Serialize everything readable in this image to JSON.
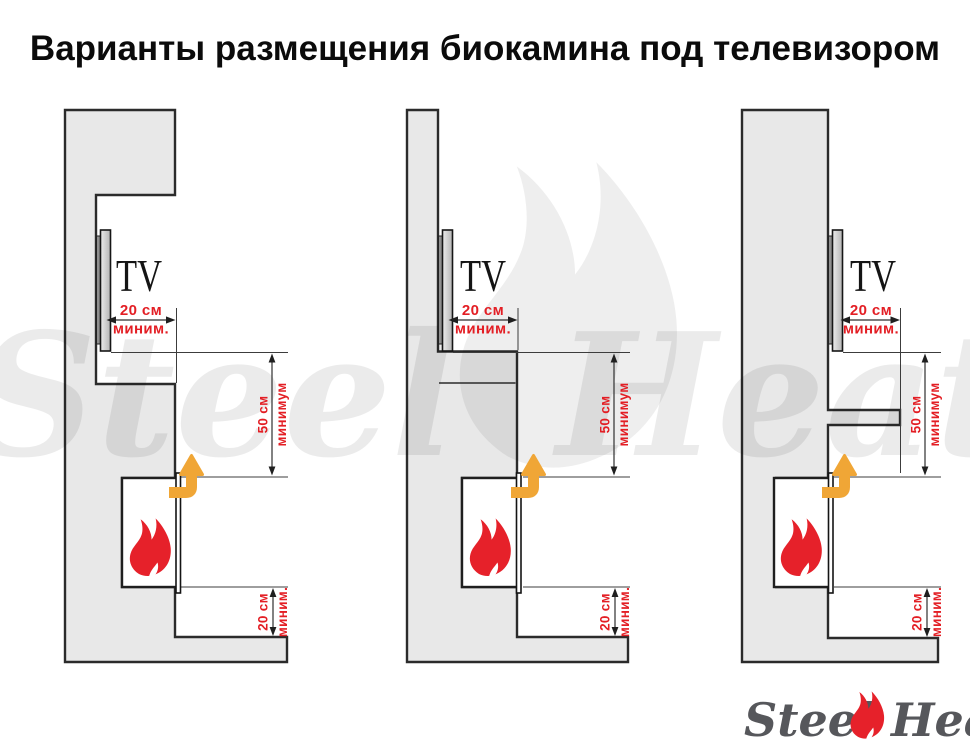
{
  "title": "Варианты размещения биокамина под телевизором",
  "labels": {
    "tv": "TV",
    "top_clearance_value": "20 см",
    "top_clearance_qualifier": "миним.",
    "vertical_clearance_value": "50 см",
    "vertical_clearance_qualifier": "минимум",
    "bottom_clearance_value": "20 см",
    "bottom_clearance_qualifier": "миним."
  },
  "watermark": {
    "word_left": "Steel",
    "word_right": "Heat"
  },
  "logo": {
    "word_left": "Steel",
    "word_right": "Heat"
  },
  "colors": {
    "wall_fill": "#e8e8e8",
    "outline": "#2b2b2b",
    "accent_red": "#e31e24",
    "flame_red": "#e6212a",
    "arrow_orange": "#f0a636",
    "logo_gray": "#56575b"
  }
}
